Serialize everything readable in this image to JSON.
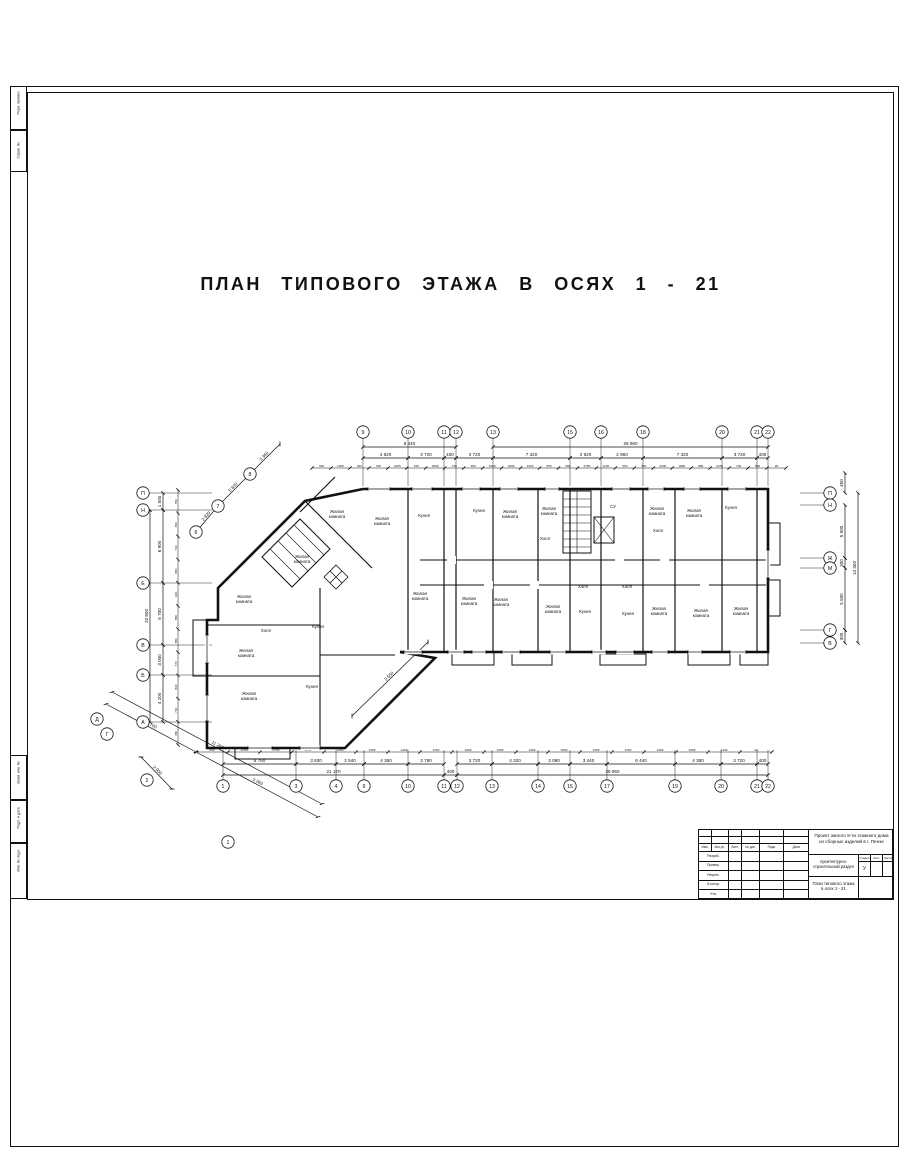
{
  "title": "ПЛАН ТИПОВОГО ЭТАЖА В ОСЯХ 1 - 21",
  "margin_labels": {
    "top1": "Перв. примен.",
    "top2": "Справ. №",
    "b1": "Взам. инв. №",
    "b2": "Подп. и дата",
    "b3": "Инв. № подл."
  },
  "stamp": {
    "project_line1": "Проект жилого 9-ти этажного дома",
    "project_line2": "из сборных изделий в г. Пензе",
    "section": "Архитектурно-строительный раздел",
    "sheet_name_line1": "План типового этажа",
    "sheet_name_line2": "в осях 1 - 21",
    "stage_value": "У",
    "header_cols": [
      "Изм.",
      "Кол.уч.",
      "Лист",
      "№ док.",
      "Подп.",
      "Дата"
    ],
    "row_labels": [
      "Разраб.",
      "Провер.",
      "Реценз.",
      "Н.контр.",
      "Утв."
    ],
    "right_header": [
      "Стадия",
      "Лист",
      "Листов"
    ]
  },
  "plan": {
    "axis_circles": [
      {
        "l": "9",
        "x": 363,
        "y": 432,
        "s": "t"
      },
      {
        "l": "10",
        "x": 408,
        "y": 432,
        "s": "t"
      },
      {
        "l": "11",
        "x": 444,
        "y": 432,
        "s": "t"
      },
      {
        "l": "12",
        "x": 456,
        "y": 432,
        "s": "t"
      },
      {
        "l": "13",
        "x": 493,
        "y": 432,
        "s": "t"
      },
      {
        "l": "15",
        "x": 570,
        "y": 432,
        "s": "t"
      },
      {
        "l": "16",
        "x": 601,
        "y": 432,
        "s": "t"
      },
      {
        "l": "18",
        "x": 643,
        "y": 432,
        "s": "t"
      },
      {
        "l": "20",
        "x": 722,
        "y": 432,
        "s": "t"
      },
      {
        "l": "21",
        "x": 757,
        "y": 432,
        "s": "t"
      },
      {
        "l": "22",
        "x": 768,
        "y": 432,
        "s": "t"
      },
      {
        "l": "1",
        "x": 223,
        "y": 786,
        "s": "b"
      },
      {
        "l": "3",
        "x": 296,
        "y": 786,
        "s": "b"
      },
      {
        "l": "4",
        "x": 336,
        "y": 786,
        "s": "b"
      },
      {
        "l": "9",
        "x": 364,
        "y": 786,
        "s": "b"
      },
      {
        "l": "10",
        "x": 408,
        "y": 786,
        "s": "b"
      },
      {
        "l": "11",
        "x": 444,
        "y": 786,
        "s": "b"
      },
      {
        "l": "12",
        "x": 457,
        "y": 786,
        "s": "b"
      },
      {
        "l": "13",
        "x": 492,
        "y": 786,
        "s": "b"
      },
      {
        "l": "14",
        "x": 538,
        "y": 786,
        "s": "b"
      },
      {
        "l": "15",
        "x": 570,
        "y": 786,
        "s": "b"
      },
      {
        "l": "17",
        "x": 607,
        "y": 786,
        "s": "b"
      },
      {
        "l": "19",
        "x": 675,
        "y": 786,
        "s": "b"
      },
      {
        "l": "20",
        "x": 721,
        "y": 786,
        "s": "b"
      },
      {
        "l": "21",
        "x": 757,
        "y": 786,
        "s": "b"
      },
      {
        "l": "22",
        "x": 768,
        "y": 786,
        "s": "b"
      },
      {
        "l": "П",
        "x": 143,
        "y": 493,
        "s": "l"
      },
      {
        "l": "Н",
        "x": 143,
        "y": 510,
        "s": "l"
      },
      {
        "l": "Е",
        "x": 143,
        "y": 583,
        "s": "l"
      },
      {
        "l": "В",
        "x": 143,
        "y": 645,
        "s": "l"
      },
      {
        "l": "Б",
        "x": 143,
        "y": 675,
        "s": "l"
      },
      {
        "l": "А",
        "x": 143,
        "y": 722,
        "s": "l"
      },
      {
        "l": "П",
        "x": 830,
        "y": 493,
        "s": "r"
      },
      {
        "l": "Н",
        "x": 830,
        "y": 505,
        "s": "r"
      },
      {
        "l": "Ж",
        "x": 830,
        "y": 558,
        "s": "r"
      },
      {
        "l": "М",
        "x": 830,
        "y": 568,
        "s": "r"
      },
      {
        "l": "Г",
        "x": 830,
        "y": 630,
        "s": "r"
      },
      {
        "l": "В",
        "x": 830,
        "y": 643,
        "s": "r"
      },
      {
        "l": "6",
        "x": 196,
        "y": 532,
        "s": "n"
      },
      {
        "l": "7",
        "x": 218,
        "y": 506,
        "s": "n"
      },
      {
        "l": "8",
        "x": 250,
        "y": 474,
        "s": "n"
      },
      {
        "l": "Д",
        "x": 97,
        "y": 719,
        "s": "n"
      },
      {
        "l": "Г",
        "x": 107,
        "y": 734,
        "s": "n"
      },
      {
        "l": "2",
        "x": 147,
        "y": 780,
        "s": "n"
      },
      {
        "l": "1",
        "x": 228,
        "y": 842,
        "s": "n"
      }
    ],
    "dims": [
      {
        "o": "h",
        "y": 447,
        "x1": 363,
        "x2": 456,
        "v": "8 440"
      },
      {
        "o": "h",
        "y": 447,
        "x1": 493,
        "x2": 768,
        "v": "28 960"
      },
      {
        "o": "h",
        "y": 458,
        "x1": 363,
        "x2": 408,
        "v": "4 920"
      },
      {
        "o": "h",
        "y": 458,
        "x1": 408,
        "x2": 444,
        "v": "3 720"
      },
      {
        "o": "h",
        "y": 458,
        "x1": 444,
        "x2": 456,
        "v": "400"
      },
      {
        "o": "h",
        "y": 458,
        "x1": 456,
        "x2": 493,
        "v": "3 720"
      },
      {
        "o": "h",
        "y": 458,
        "x1": 493,
        "x2": 570,
        "v": "7 320"
      },
      {
        "o": "h",
        "y": 458,
        "x1": 570,
        "x2": 601,
        "v": "2 920"
      },
      {
        "o": "h",
        "y": 458,
        "x1": 601,
        "x2": 643,
        "v": "2 960"
      },
      {
        "o": "h",
        "y": 458,
        "x1": 643,
        "x2": 722,
        "v": "7 320"
      },
      {
        "o": "h",
        "y": 458,
        "x1": 722,
        "x2": 757,
        "v": "3 720"
      },
      {
        "o": "h",
        "y": 458,
        "x1": 757,
        "x2": 768,
        "v": "400"
      },
      {
        "o": "h",
        "y": 764,
        "x1": 223,
        "x2": 296,
        "v": "6 760"
      },
      {
        "o": "h",
        "y": 764,
        "x1": 296,
        "x2": 336,
        "v": "3 830"
      },
      {
        "o": "h",
        "y": 764,
        "x1": 336,
        "x2": 364,
        "v": "2 540"
      },
      {
        "o": "h",
        "y": 764,
        "x1": 364,
        "x2": 408,
        "v": "4 380"
      },
      {
        "o": "h",
        "y": 764,
        "x1": 408,
        "x2": 444,
        "v": "3 780"
      },
      {
        "o": "h",
        "y": 764,
        "x1": 457,
        "x2": 492,
        "v": "3 720"
      },
      {
        "o": "h",
        "y": 764,
        "x1": 492,
        "x2": 538,
        "v": "4 320"
      },
      {
        "o": "h",
        "y": 764,
        "x1": 538,
        "x2": 570,
        "v": "3 080"
      },
      {
        "o": "h",
        "y": 764,
        "x1": 570,
        "x2": 607,
        "v": "3 440"
      },
      {
        "o": "h",
        "y": 764,
        "x1": 607,
        "x2": 675,
        "v": "6 440"
      },
      {
        "o": "h",
        "y": 764,
        "x1": 675,
        "x2": 721,
        "v": "4 380"
      },
      {
        "o": "h",
        "y": 764,
        "x1": 721,
        "x2": 757,
        "v": "3 720"
      },
      {
        "o": "h",
        "y": 764,
        "x1": 757,
        "x2": 768,
        "v": "400"
      },
      {
        "o": "h",
        "y": 775,
        "x1": 223,
        "x2": 444,
        "v": "21 170"
      },
      {
        "o": "h",
        "y": 775,
        "x1": 444,
        "x2": 457,
        "v": "400"
      },
      {
        "o": "h",
        "y": 775,
        "x1": 457,
        "x2": 768,
        "v": "28 960"
      },
      {
        "o": "v",
        "x": 163,
        "y1": 493,
        "y2": 510,
        "v": "1 500"
      },
      {
        "o": "v",
        "x": 163,
        "y1": 510,
        "y2": 583,
        "v": "6 900"
      },
      {
        "o": "v",
        "x": 163,
        "y1": 583,
        "y2": 645,
        "v": "5 700"
      },
      {
        "o": "v",
        "x": 163,
        "y1": 645,
        "y2": 675,
        "v": "3 000"
      },
      {
        "o": "v",
        "x": 163,
        "y1": 675,
        "y2": 722,
        "v": "4 200"
      },
      {
        "o": "v",
        "x": 150,
        "y1": 510,
        "y2": 722,
        "v": "20 600"
      },
      {
        "o": "v",
        "x": 845,
        "y1": 473,
        "y2": 493,
        "v": "450"
      },
      {
        "o": "v",
        "x": 845,
        "y1": 505,
        "y2": 558,
        "v": "5 500"
      },
      {
        "o": "v",
        "x": 845,
        "y1": 558,
        "y2": 568,
        "v": "300"
      },
      {
        "o": "v",
        "x": 845,
        "y1": 568,
        "y2": 630,
        "v": "5 500"
      },
      {
        "o": "v",
        "x": 845,
        "y1": 630,
        "y2": 643,
        "v": "300"
      },
      {
        "o": "v",
        "x": 858,
        "y1": 493,
        "y2": 643,
        "v": "14 300"
      },
      {
        "o": "d",
        "x1": 196,
        "y1": 532,
        "x2": 218,
        "y2": 506,
        "v": "2 920"
      },
      {
        "o": "d",
        "x1": 218,
        "y1": 506,
        "x2": 250,
        "y2": 474,
        "v": "5 600"
      },
      {
        "o": "d",
        "x1": 250,
        "y1": 474,
        "x2": 280,
        "y2": 444,
        "v": "3 360"
      },
      {
        "o": "d",
        "x1": 106,
        "y1": 704,
        "x2": 196,
        "y2": 752,
        "v": "6 700"
      },
      {
        "o": "d",
        "x1": 196,
        "y1": 752,
        "x2": 318,
        "y2": 817,
        "v": "3 260"
      },
      {
        "o": "d",
        "x1": 112,
        "y1": 692,
        "x2": 322,
        "y2": 804,
        "v": "11 260"
      },
      {
        "o": "d",
        "x1": 141,
        "y1": 757,
        "x2": 172,
        "y2": 789,
        "v": "2 900"
      },
      {
        "o": "d",
        "x1": 352,
        "y1": 716,
        "x2": 428,
        "y2": 642,
        "v": "3 550"
      }
    ],
    "small_dims": [
      {
        "o": "h",
        "y": 468,
        "x1": 312,
        "x2": 786,
        "vals": [
          "390",
          "1200",
          "220",
          "790",
          "2225",
          "150",
          "2050",
          "730",
          "250",
          "1500",
          "1600",
          "1200",
          "550",
          "580",
          "2750",
          "1100",
          "500",
          "550",
          "2200",
          "1800",
          "890",
          "2230",
          "730",
          "550",
          "20"
        ]
      },
      {
        "o": "h",
        "y": 752,
        "x1": 196,
        "x2": 772,
        "vals": [
          "450",
          "1250",
          "1750",
          "1250",
          "1300",
          "1450",
          "1300",
          "1150",
          "1900",
          "1250",
          "1300",
          "1500",
          "1450",
          "1150",
          "1300",
          "1950",
          "1440",
          "20"
        ]
      },
      {
        "o": "v",
        "x": 178,
        "y1": 490,
        "y2": 745,
        "vals": [
          "750",
          "450",
          "730",
          "880",
          "600",
          "550",
          "580",
          "770",
          "890",
          "730",
          "450"
        ]
      }
    ],
    "windows": [
      {
        "o": "h",
        "x": 368,
        "y": 489,
        "l": 22
      },
      {
        "o": "h",
        "x": 412,
        "y": 489,
        "l": 20
      },
      {
        "o": "h",
        "x": 462,
        "y": 489,
        "l": 18
      },
      {
        "o": "h",
        "x": 500,
        "y": 489,
        "l": 18
      },
      {
        "o": "h",
        "x": 545,
        "y": 489,
        "l": 14
      },
      {
        "o": "h",
        "x": 612,
        "y": 489,
        "l": 18
      },
      {
        "o": "h",
        "x": 648,
        "y": 489,
        "l": 16
      },
      {
        "o": "h",
        "x": 684,
        "y": 489,
        "l": 16
      },
      {
        "o": "h",
        "x": 728,
        "y": 489,
        "l": 18
      },
      {
        "o": "h",
        "x": 404,
        "y": 652,
        "l": 18
      },
      {
        "o": "h",
        "x": 448,
        "y": 652,
        "l": 16
      },
      {
        "o": "h",
        "x": 472,
        "y": 652,
        "l": 14
      },
      {
        "o": "h",
        "x": 502,
        "y": 652,
        "l": 18
      },
      {
        "o": "h",
        "x": 550,
        "y": 652,
        "l": 16
      },
      {
        "o": "h",
        "x": 592,
        "y": 652,
        "l": 14
      },
      {
        "o": "h",
        "x": 616,
        "y": 652,
        "l": 18
      },
      {
        "o": "h",
        "x": 652,
        "y": 652,
        "l": 16
      },
      {
        "o": "h",
        "x": 688,
        "y": 652,
        "l": 14
      },
      {
        "o": "h",
        "x": 730,
        "y": 652,
        "l": 16
      },
      {
        "o": "v",
        "x": 768,
        "y": 550,
        "l": 28
      },
      {
        "o": "v",
        "x": 207,
        "y": 635,
        "l": 28
      },
      {
        "o": "v",
        "x": 207,
        "y": 695,
        "l": 26
      },
      {
        "o": "h",
        "x": 248,
        "y": 748,
        "l": 24
      },
      {
        "o": "h",
        "x": 300,
        "y": 748,
        "l": 20
      }
    ],
    "rooms": [
      {
        "t": "Жилая\nкомната",
        "x": 337,
        "y": 513
      },
      {
        "t": "Жилая\nкомната",
        "x": 382,
        "y": 520
      },
      {
        "t": "Кухня",
        "x": 424,
        "y": 517
      },
      {
        "t": "Кухня",
        "x": 479,
        "y": 512
      },
      {
        "t": "Жилая\nкомната",
        "x": 510,
        "y": 513
      },
      {
        "t": "Жилая\nкомната",
        "x": 549,
        "y": 510
      },
      {
        "t": "СУ",
        "x": 613,
        "y": 508
      },
      {
        "t": "Жилая\nкомната",
        "x": 657,
        "y": 510
      },
      {
        "t": "Жилая\nкомната",
        "x": 694,
        "y": 512
      },
      {
        "t": "Кухня",
        "x": 731,
        "y": 509
      },
      {
        "t": "Холл",
        "x": 658,
        "y": 532
      },
      {
        "t": "Холл",
        "x": 545,
        "y": 540
      },
      {
        "t": "Холл",
        "x": 583,
        "y": 588
      },
      {
        "t": "Холл",
        "x": 627,
        "y": 588
      },
      {
        "t": "Жилая\nкомната",
        "x": 420,
        "y": 595
      },
      {
        "t": "Жилая\nкомната",
        "x": 469,
        "y": 600
      },
      {
        "t": "Жилая\nкомната",
        "x": 501,
        "y": 601
      },
      {
        "t": "Жилая\nкомната",
        "x": 553,
        "y": 608
      },
      {
        "t": "Кухня",
        "x": 585,
        "y": 613
      },
      {
        "t": "Кухня",
        "x": 628,
        "y": 615
      },
      {
        "t": "Жилая\nкомната",
        "x": 659,
        "y": 610
      },
      {
        "t": "Жилая\nкомната",
        "x": 701,
        "y": 612
      },
      {
        "t": "Жилая\nкомната",
        "x": 741,
        "y": 610
      },
      {
        "t": "Жилая\nкомната",
        "x": 302,
        "y": 558
      },
      {
        "t": "Жилая\nкомната",
        "x": 244,
        "y": 598
      },
      {
        "t": "Холл",
        "x": 266,
        "y": 632
      },
      {
        "t": "Кухня",
        "x": 318,
        "y": 628
      },
      {
        "t": "Жилая\nкомната",
        "x": 246,
        "y": 652
      },
      {
        "t": "Жилая\nкомната",
        "x": 249,
        "y": 695
      },
      {
        "t": "Кухня",
        "x": 312,
        "y": 688
      }
    ]
  }
}
